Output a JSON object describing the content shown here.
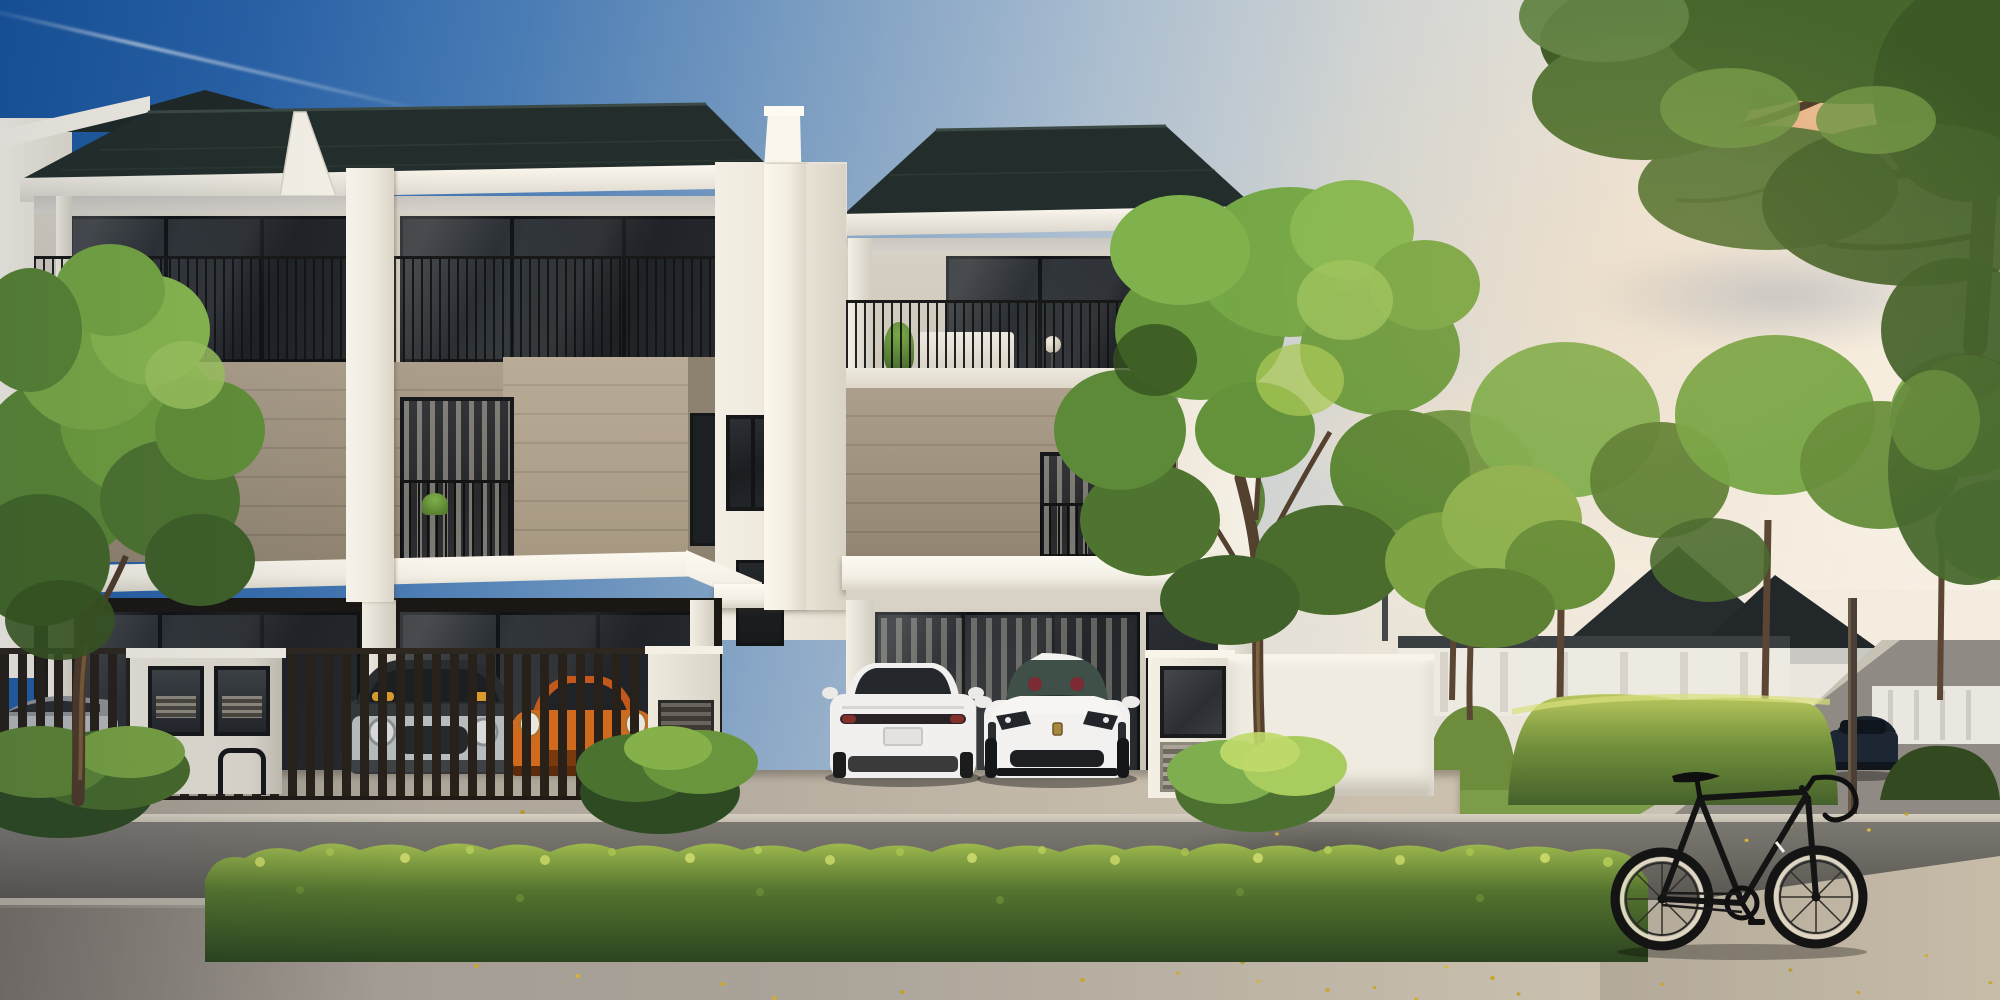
{
  "meta": {
    "description": "Golden-hour architectural rendering of modern three-storey terrace homes with carports, a landscaped street, parked electric cars and a black fixie bicycle leaning on a hedge",
    "time_of_day": "sunset golden hour",
    "style": "photorealistic 3D exterior visualization",
    "text_visible": "none"
  },
  "palette": {
    "sky_deep_blue": "#17549e",
    "sky_pale_cream": "#f7f0e2",
    "cloud_warm": "#e7b083",
    "roof": "#232e2c",
    "fascia_white": "#f7f3ea",
    "wall_cream": "#ddd7cb",
    "wall_taupe": "#a3947e",
    "wall_taupe_light": "#b0a189",
    "wall_white": "#efebe0",
    "panel_dark": "#3a342d",
    "glass_dark": "#23262a",
    "railing_black": "#181818",
    "gate_timber": "#27211a",
    "hedge_light": "#b7c95d",
    "hedge_dark": "#2c4420",
    "foliage_light": "#9cc45e",
    "foliage_mid": "#6f9c3f",
    "foliage_dark": "#42672a",
    "trunk_brown": "#54402e",
    "road_asphalt": "#6b6862",
    "curb": "#cfc9bc",
    "sidewalk": "#a9a29a",
    "lawn": "#7d9c49",
    "leaf_yellow": "#caa73a"
  },
  "sky": {
    "gradient": [
      "#17549e",
      "#7fa0c3",
      "#f7f0e2"
    ],
    "contrail": "thin white jet trail upper left",
    "clouds": [
      "warm orange cloud top right",
      "soft pink cloud band mid right",
      "grey-blue streak right",
      "pale haze near horizon"
    ]
  },
  "buildings": {
    "left_terrace": {
      "units": 2,
      "storeys": 3,
      "roof": "dark slate hip roof with white fascia and gutter",
      "third_floor": "full-width balconies, slim black vertical railings, dark framed sliding glass, potted plants and rattan chairs",
      "second_floor": "taupe horizontal-panel band with two black framed windows and juliet railings, projecting taupe bay",
      "ground_floor": "white porch canopy over glazed carport walls, white columns",
      "party_walls": "white blade fins rising above the roofline"
    },
    "right_terrace": {
      "units": 1,
      "storeys": 3,
      "roof": "dark slate hip roof with white fascia",
      "third_floor_items": [
        "white shelf unit",
        "globe floor lamp",
        "potted plant"
      ],
      "second_floor": "taupe band, curtained window with juliet bars, dark charcoal accent panel",
      "ground_floor": "open double carport with glazed wall and entry door"
    },
    "neighbor_left": "white corner house partially visible at frame edge",
    "background": {
      "clubhouse_wall": "long white colonnade wall",
      "pergola": "flat dark canopy on slim posts",
      "distant_house_roof": "#262b2e",
      "white_fence": "low white fence at far right",
      "lamp_post": "timber pole by distant road"
    }
  },
  "vehicles": [
    {
      "name": "tesla-model-s",
      "color": "#f1f0ee",
      "view": "rear",
      "location": "right carport, left bay"
    },
    {
      "name": "porsche-taycan",
      "color": "#f2f1ef",
      "view": "front",
      "location": "right carport, right bay",
      "interior_accent": "#7c2a33"
    },
    {
      "name": "porsche-911",
      "color": "#cf6a1e",
      "view": "front",
      "location": "left carport behind slatted gate"
    },
    {
      "name": "mini-suv",
      "color": "#34383b",
      "view": "front",
      "location": "left carport behind slatted gate"
    },
    {
      "name": "silver-sedan",
      "color": "#b6b9bb",
      "view": "side",
      "location": "far left behind fence"
    },
    {
      "name": "dark-suv",
      "color": "#1d2733",
      "view": "rear",
      "location": "distant street, right side"
    }
  ],
  "bicycle": {
    "type": "black single-speed road bike with drop handlebars",
    "frame_color": "#141414",
    "tire_sidewall": "#ded6c2",
    "location": "foreground right, leaning against hedge"
  },
  "landscape": {
    "front_hedge": "low clipped hedge strip along the street, sunlit yellow-green tops",
    "hedge_bank": "tall trimmed hedge bank behind the bicycle",
    "lawn": "#7d9c49",
    "trees": [
      "street tree left foreground",
      "large street tree right of the homes",
      "small tree beside boundary wall",
      "row of distant trees",
      "overhanging branch top right corner"
    ],
    "bushes": 3,
    "fallen_leaves": "#caa73a"
  },
  "street": {
    "road": "#6b6862",
    "curb": "#cfc9bc",
    "sidewalk": "#a9a29a",
    "driveway": "light paver forecourt"
  },
  "site": {
    "gate": "dark timber slatted carport gate",
    "mailbox_unit": "white letterbox wall with two framed panels and louvre vents",
    "bike_rack": "black steel hoop",
    "boundary_wall_color": "#efebe0",
    "gate_pillar": "white pillar with glass panel and louvre vent"
  }
}
